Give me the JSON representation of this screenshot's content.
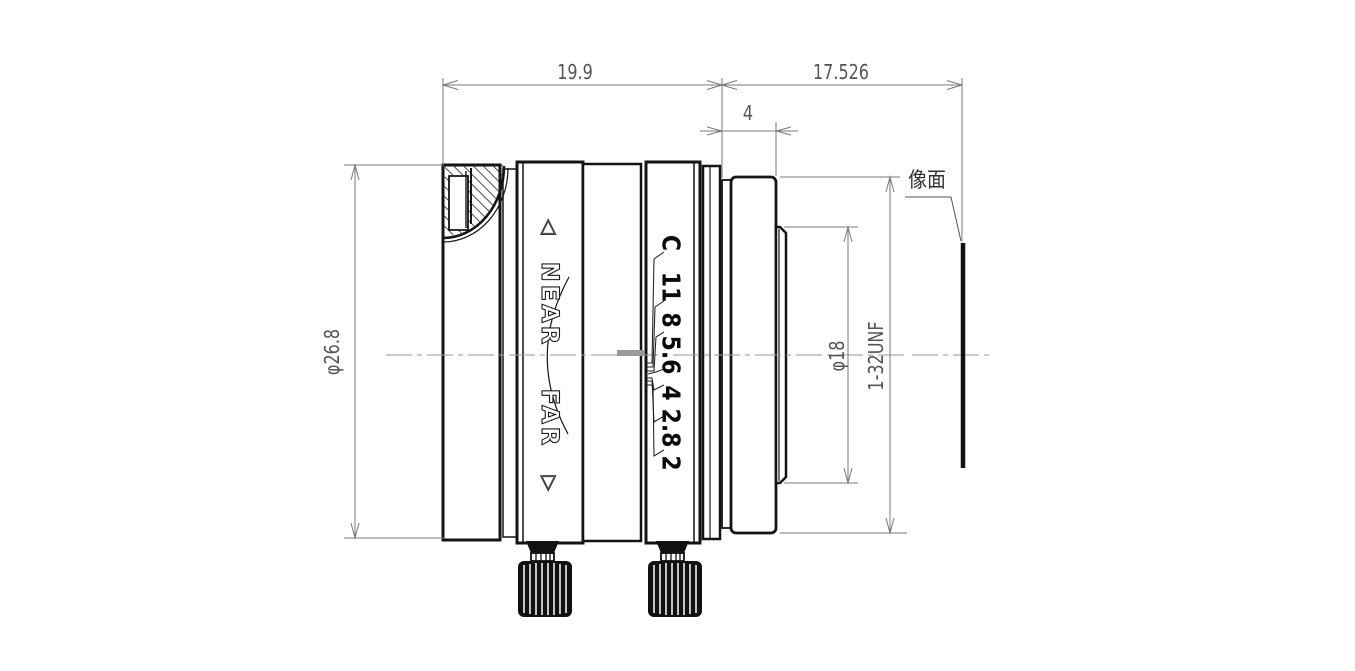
{
  "dimensions": {
    "front_length": "19.9",
    "flange_focal_distance": "17.526",
    "mount_flange_width": "4",
    "barrel_diameter": "φ26.8",
    "thread_diameter": "φ18",
    "thread_spec": "1-32UNF",
    "image_plane_label": "像面"
  },
  "focus_ring": {
    "marker_near": "◁",
    "near_label": "NEAR",
    "far_label": "FAR",
    "marker_far": "▷"
  },
  "aperture_scale": {
    "labels": [
      "C",
      "11",
      "8",
      "5.6",
      "4",
      "2.8",
      "2"
    ]
  },
  "colors": {
    "line": "#141414",
    "dimension_line": "#7a7a7a",
    "dimension_text": "#555555",
    "centerline": "#9a9a9a",
    "index_mark": "#999999",
    "background": "#ffffff"
  }
}
